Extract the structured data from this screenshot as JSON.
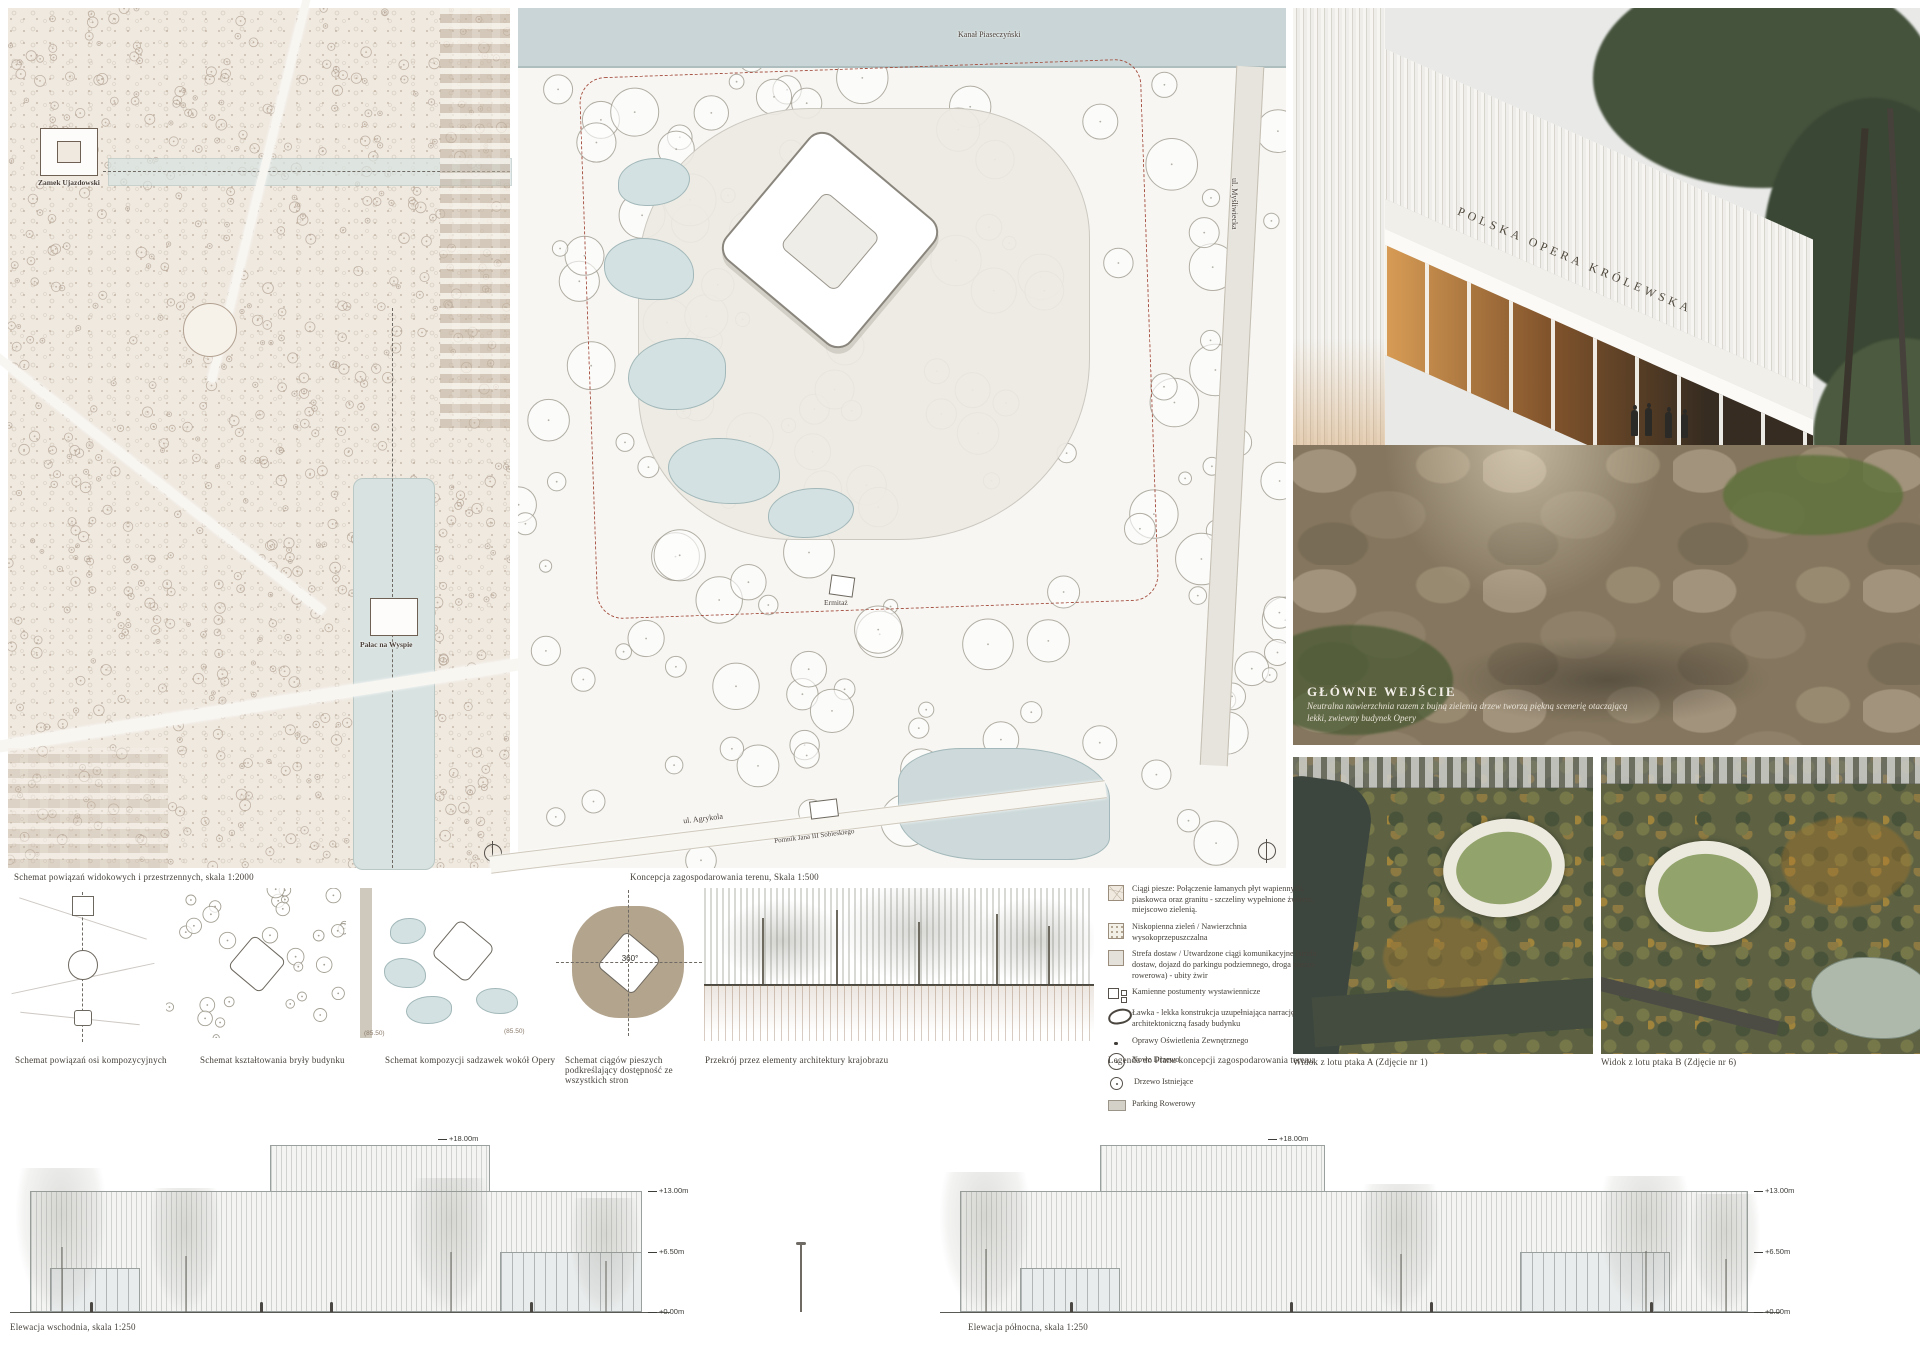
{
  "site_plan": {
    "caption": "Schemat powiązań widokowych i przestrzennych, skala 1:2000",
    "label_castle": "Zamek Ujazdowski",
    "label_palace": "Pałac na Wyspie"
  },
  "concept_plan": {
    "caption": "Koncepcja zagospodarowania terenu, Skala 1:500",
    "label_canal": "Kanał Piaseczyński",
    "label_street_right": "ul. Myśliwiecka",
    "label_street_bottom": "ul. Agrykola",
    "label_monument": "Pomnik Jana III Sobieskiego",
    "label_hermitage": "Ermitaż"
  },
  "render": {
    "building_sign": "POLSKA OPERA KRÓLEWSKA",
    "caption_title": "GŁÓWNE WEJŚCIE",
    "caption_line1": "Neutralna nawierzchnia razem z bujną zielenią drzew tworzą piękną scenerię otaczającą",
    "caption_line2": "lekki, zwiewny budynek Opery"
  },
  "diagrams": {
    "d1_caption": "Schemat powiązań osi kompozycyjnych",
    "d2_caption": "Schemat kształtowania bryły budynku",
    "d3_caption": "Schemat kompozycji sadzawek wokół Opery",
    "d3_level_a": "(85.50)",
    "d3_level_b": "(85.50)",
    "d4_caption": "Schemat ciągów pieszych podkreślający dostępność ze wszystkich stron",
    "d4_badge": "360°",
    "d5_caption": "Przekrój przez elementy architektury krajobrazu"
  },
  "legend": {
    "caption": "Legenda do Planu koncepcji zagospodarowania terenu",
    "items": [
      {
        "text": "Ciągi piesze: Połączenie łamanych płyt wapiennych, piaskowca oraz granitu - szczeliny wypełnione żwirem, miejscowo zielenią."
      },
      {
        "text": "Niskopienna zieleń / Nawierzchnia wysokoprzepuszczalna"
      },
      {
        "text": "Strefa dostaw / Utwardzone ciągi komunikacyjne (strefa dostaw, dojazd do parkingu podziemnego, droga pieszo-rowerowa) - ubity żwir"
      },
      {
        "text": "Kamienne postumenty wystawiennicze"
      },
      {
        "text": "Ławka - lekka konstrukcja uzupełniająca narrację architektoniczną fasady budynku"
      },
      {
        "text": "Oprawy Oświetlenia Zewnętrznego"
      },
      {
        "text": "Nowe Drzewo"
      },
      {
        "text": "Drzewo Istniejące"
      },
      {
        "text": "Parking Rowerowy"
      }
    ]
  },
  "aerials": {
    "a_caption": "Widok z lotu ptaka A (Zdjęcie nr 1)",
    "b_caption": "Widok z lotu ptaka B (Zdjęcie nr 6)"
  },
  "elevations": {
    "east_caption": "Elewacja wschodnia, skala 1:250",
    "north_caption": "Elewacja północna, skala 1:250",
    "level_18": "+18.00m",
    "level_13": "+13.00m",
    "level_6": "+6.50m",
    "level_0": "+0.00m"
  },
  "colors": {
    "map_paper": "#efe9e0",
    "water": "#d8e2e0",
    "red_boundary": "#a65243",
    "interior_glow": "#d99a4e",
    "autumn_canopy": "#5e6243"
  }
}
